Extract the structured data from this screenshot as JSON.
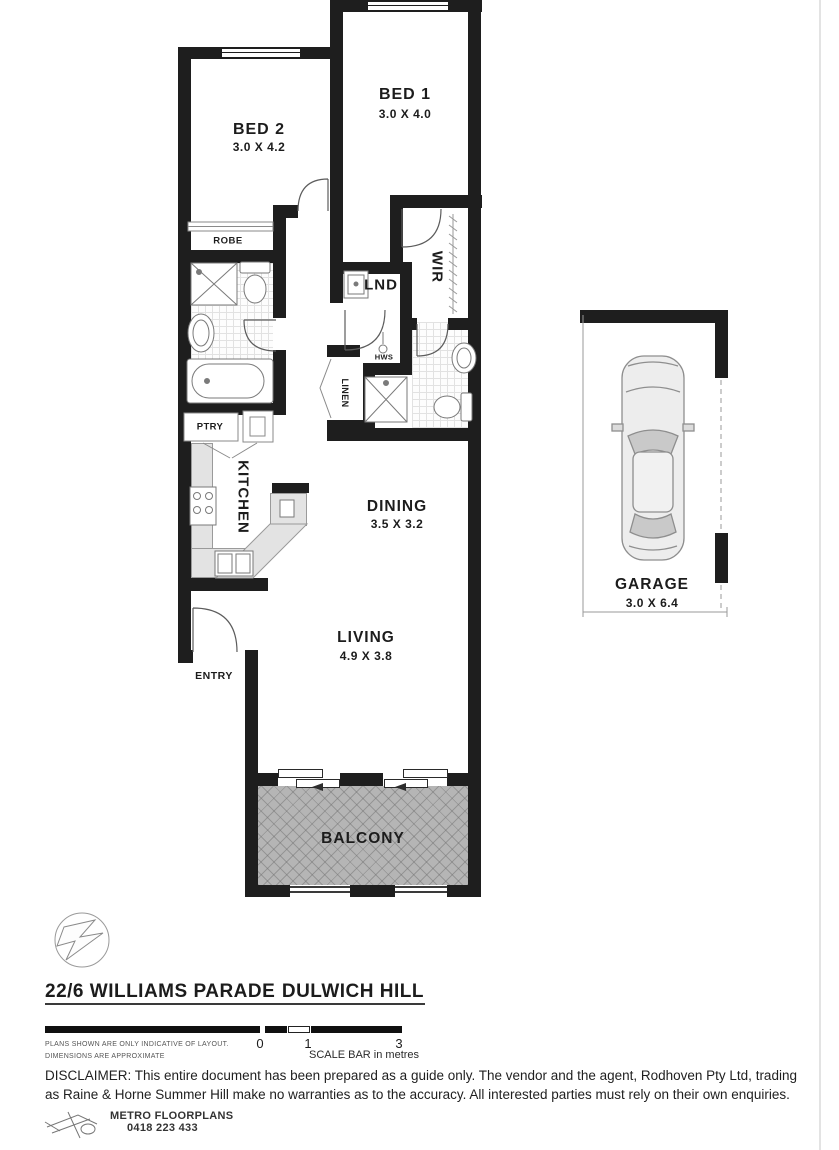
{
  "plan": {
    "rooms": {
      "bed1": {
        "name": "BED 1",
        "dims": "3.0 X 4.0"
      },
      "bed2": {
        "name": "BED 2",
        "dims": "3.0 X 4.2"
      },
      "robe": {
        "name": "ROBE"
      },
      "wir": {
        "name": "WIR"
      },
      "lnd": {
        "name": "LND"
      },
      "hws": {
        "name": "HWS"
      },
      "linen": {
        "name": "LINEN"
      },
      "ptry": {
        "name": "PTRY"
      },
      "kitchen": {
        "name": "KITCHEN"
      },
      "dining": {
        "name": "DINING",
        "dims": "3.5 X 3.2"
      },
      "living": {
        "name": "LIVING",
        "dims": "4.9 X 3.8"
      },
      "entry": {
        "name": "ENTRY"
      },
      "balcony": {
        "name": "BALCONY"
      },
      "garage": {
        "name": "GARAGE",
        "dims": "3.0 X 6.4"
      }
    }
  },
  "footer": {
    "address_street": "22/6 WILLIAMS PARADE",
    "address_suburb": "DULWICH HILL",
    "note_line1": "PLANS SHOWN ARE ONLY INDICATIVE OF LAYOUT.",
    "note_line2": "DIMENSIONS ARE APPROXIMATE",
    "scale": {
      "zero": "0",
      "one": "1",
      "three": "3",
      "caption": "SCALE BAR in metres"
    },
    "disclaimer": "DISCLAIMER: This entire document has been prepared as a guide only. The vendor and the agent, Rodhoven Pty Ltd,  trading as Raine & Horne Summer Hill make no warranties as to the accuracy. All interested parties must rely on their own enquiries.",
    "maker": {
      "company": "METRO FLOORPLANS",
      "phone": "0418 223 433"
    }
  },
  "colors": {
    "wall": "#1e1e1e",
    "balcony_fill": "#b5b5b5",
    "bench_fill": "#e3e3e3"
  }
}
